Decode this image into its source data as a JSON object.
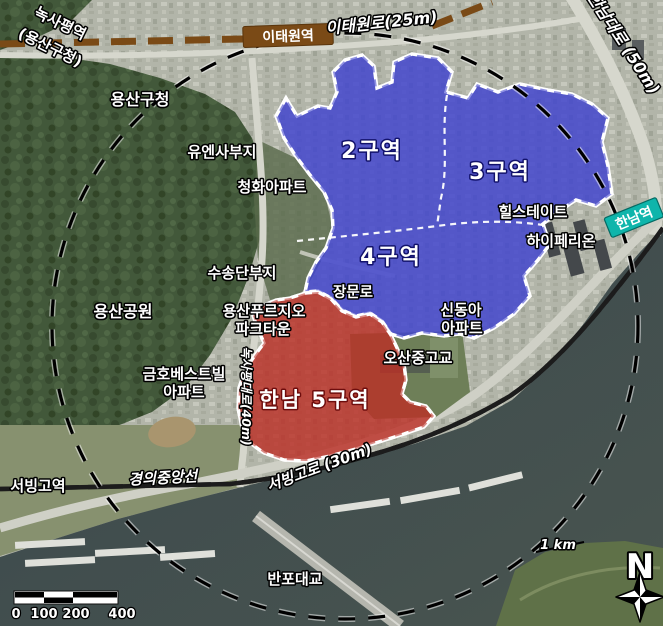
{
  "stations": {
    "noksapyeong_line1": "녹사평역",
    "noksapyeong_line2": "(용산구청)",
    "itaewon": "이태원역",
    "hannam": "한남역",
    "seobinggo": "서빙고역"
  },
  "roads": {
    "itaewon_ro": "이태원로(25m)",
    "hannam_daero": "한남대로 (50m)",
    "noksapyeong_daero": "녹사평대로(40m)",
    "seobinggo_ro": "서빙고로 (30m)",
    "jangmun_ro": "장문로",
    "gyeongui_jungang_line": "경의중앙선",
    "banpo_bridge": "반포대교"
  },
  "districts": {
    "d2": "2구역",
    "d3": "3구역",
    "d4": "4구역",
    "d5": "한남 5구역"
  },
  "places": {
    "yongsan_gu_office": "용산구청",
    "un_site": "유엔사부지",
    "cheonghwa_apt": "청화아파트",
    "susongdan_site": "수송단부지",
    "yongsan_park": "용산공원",
    "prugio_line1": "용산푸르지오",
    "prugio_line2": "파크타운",
    "hillstate": "힐스테이트",
    "hyperion": "하이페리온",
    "sindonga_line1": "신동아",
    "sindonga_line2": "아파트",
    "osan_school": "오산중고교",
    "kumho_line1": "금호베스트빌",
    "kumho_line2": "아파트"
  },
  "marks": {
    "radius_label": "1 km",
    "north": "N",
    "scale": [
      "0",
      "100",
      "200",
      "400"
    ]
  },
  "colors": {
    "zone_blue": "#3f43cf",
    "zone_red": "#bb2f26",
    "border_dash_red": "#ee2e24",
    "rail_teal": "#17cec4",
    "subway_brown": "#7a4a16",
    "station_box_teal": "#0fb5ab"
  }
}
